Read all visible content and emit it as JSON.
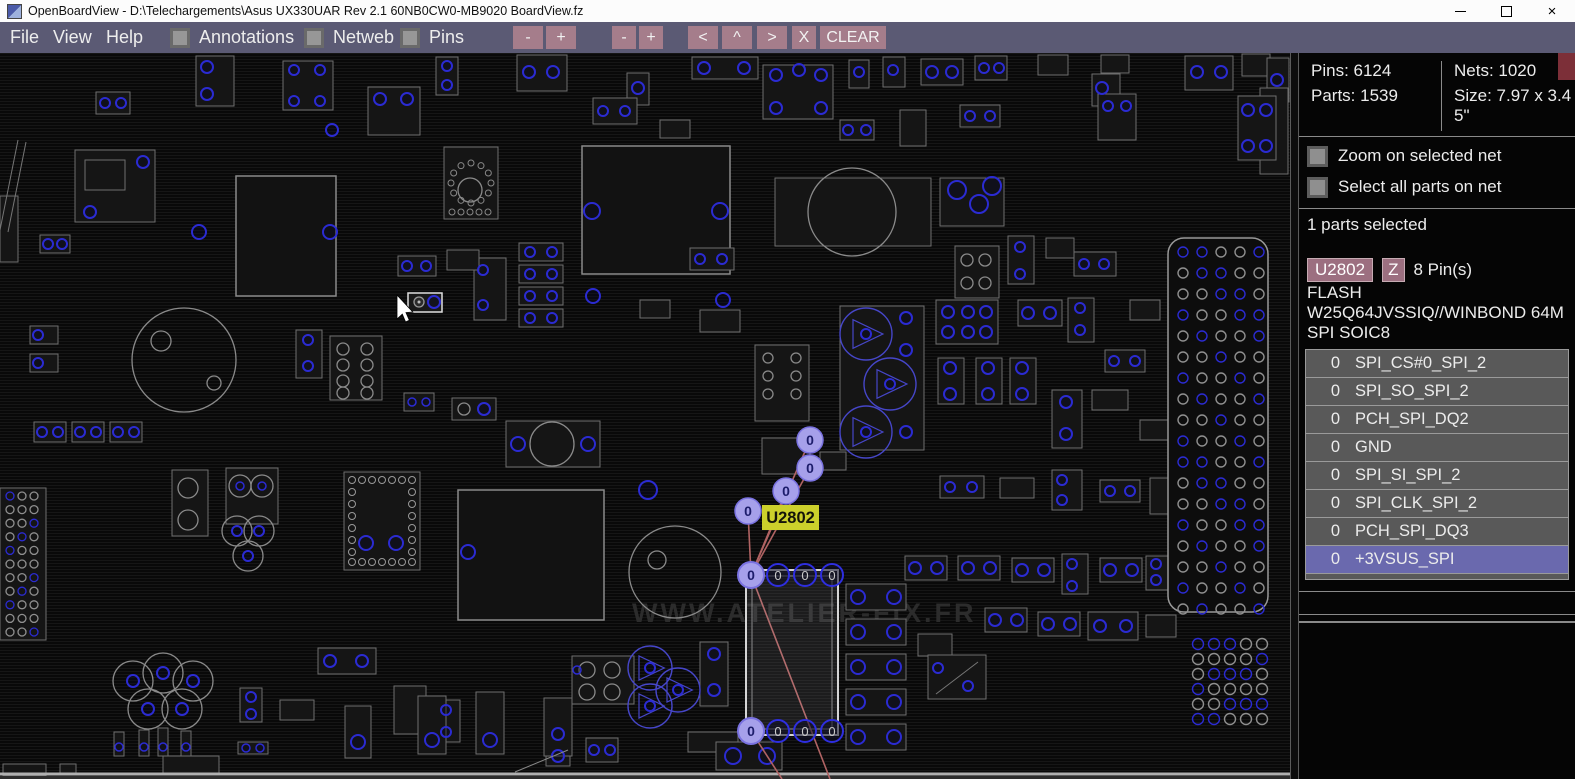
{
  "window": {
    "title": "OpenBoardView - D:\\Telechargements\\Asus UX330UAR Rev 2.1 60NB0CW0-MB9020 BoardView.fz",
    "close_glyph": "×"
  },
  "menu": {
    "items": [
      "File",
      "View",
      "Help"
    ],
    "toggles": [
      {
        "label": "Annotations",
        "checked": false
      },
      {
        "label": "Netweb",
        "checked": false
      },
      {
        "label": "Pins",
        "checked": false
      }
    ],
    "buttons": [
      "-",
      "+",
      "-",
      "+",
      "<",
      "^",
      ">",
      "X",
      "CLEAR"
    ]
  },
  "board": {
    "selected_part_label": "U2802",
    "net_pin_label": "0",
    "watermark": "WWW.ATELIER-FIX.FR"
  },
  "panel": {
    "stats": {
      "pins": "Pins: 6124",
      "parts": "Parts: 1539",
      "nets": "Nets: 1020",
      "size": "Size: 7.97 x 3.45\""
    },
    "toggles": [
      "Zoom on selected net",
      "Select all parts on net"
    ],
    "selection_status": "1 parts selected",
    "part": {
      "ref": "U2802",
      "z": "Z",
      "pin_count": "8 Pin(s)",
      "type": "FLASH",
      "value": "W25Q64JVSSIQ//WINBOND 64M",
      "package": "SPI SOIC8"
    },
    "pins": [
      {
        "num": "0",
        "net": "SPI_CS#0_SPI_2",
        "selected": false
      },
      {
        "num": "0",
        "net": "SPI_SO_SPI_2",
        "selected": false
      },
      {
        "num": "0",
        "net": "PCH_SPI_DQ2",
        "selected": false
      },
      {
        "num": "0",
        "net": "GND",
        "selected": false
      },
      {
        "num": "0",
        "net": "SPI_SI_SPI_2",
        "selected": false
      },
      {
        "num": "0",
        "net": "SPI_CLK_SPI_2",
        "selected": false
      },
      {
        "num": "0",
        "net": "PCH_SPI_DQ3",
        "selected": false
      },
      {
        "num": "0",
        "net": "+3VSUS_SPI",
        "selected": true
      }
    ]
  },
  "colors": {
    "menubar_bg": "#5b5a74",
    "menu_button_bg": "#a57d8b",
    "selected_row_bg": "#6a69ae",
    "net_highlight_fill": "#a6a0ea",
    "netweb_line": "#b06363",
    "part_label_bg": "#ccd02b",
    "pin_blue": "#2b2bd2"
  }
}
